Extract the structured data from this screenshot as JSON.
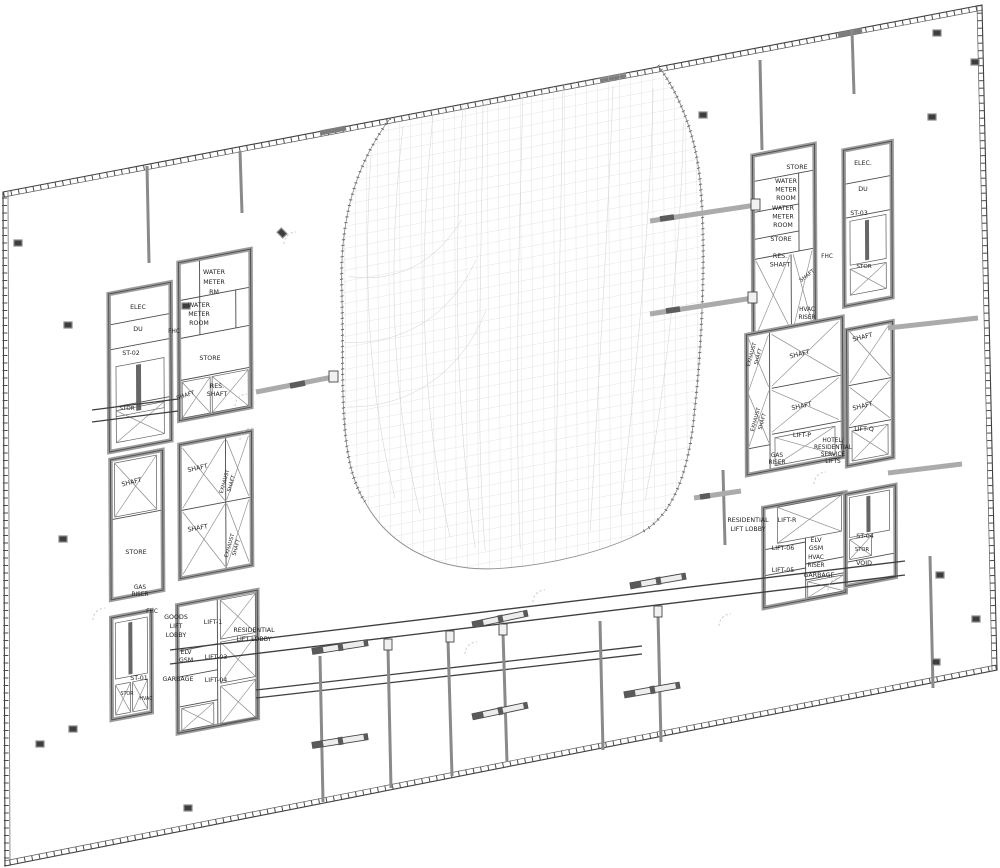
{
  "drawing": {
    "type": "architectural-floor-plan",
    "description": "High-rise tower typical floor plan, skewed axonometric view, central curved atrium void with gridshell mesh, two service cores with lifts, stairs and risers",
    "colors": {
      "background": "#ffffff",
      "line": "#3f3f3f",
      "wall_gray": "#9c9c9c",
      "mesh_gray": "#cbcbcb"
    }
  },
  "labels": [
    {
      "text": "ELEC",
      "x": 138,
      "y": 309
    },
    {
      "text": "DU",
      "x": 138,
      "y": 331
    },
    {
      "text": "ST-02",
      "x": 131,
      "y": 355
    },
    {
      "text": "STOR",
      "x": 127,
      "y": 410,
      "size": 5.6
    },
    {
      "text": "WATER\nMETER\nRM",
      "x": 214,
      "y": 274,
      "lead": 10
    },
    {
      "text": "WATER\nMETER\nROOM",
      "x": 199,
      "y": 307,
      "lead": 9
    },
    {
      "text": "FHC",
      "x": 174,
      "y": 333,
      "size": 5.8
    },
    {
      "text": "STORE",
      "x": 210,
      "y": 360
    },
    {
      "text": "SHAFT",
      "x": 186,
      "y": 397,
      "rot": -18,
      "size": 5.8
    },
    {
      "text": "RES.\nSHAFT",
      "x": 217,
      "y": 388,
      "lead": 8
    },
    {
      "text": "SHAFT",
      "x": 132,
      "y": 484,
      "rot": -14
    },
    {
      "text": "STORE",
      "x": 136,
      "y": 554
    },
    {
      "text": "GAS\nRISER",
      "x": 140,
      "y": 589,
      "lead": 7,
      "size": 5.8
    },
    {
      "text": "EXHAUST\nSHAFT",
      "x": 226,
      "y": 482,
      "rot": -74,
      "size": 5.2,
      "lead": 7
    },
    {
      "text": "SHAFT",
      "x": 198,
      "y": 470,
      "rot": -12
    },
    {
      "text": "SHAFT",
      "x": 198,
      "y": 530,
      "rot": -10
    },
    {
      "text": "EXHAUST\nSHAFT",
      "x": 231,
      "y": 546,
      "rot": -74,
      "size": 5.2,
      "lead": 7
    },
    {
      "text": "FHC",
      "x": 152,
      "y": 613,
      "size": 5.8
    },
    {
      "text": "GOODS\nLIFT\nLOBBY",
      "x": 176,
      "y": 619,
      "lead": 9
    },
    {
      "text": "LIFT-1",
      "x": 213,
      "y": 624
    },
    {
      "text": "RESIDENTIAL\nLIFT LOBBY",
      "x": 254,
      "y": 632,
      "lead": 9
    },
    {
      "text": "ELV\nGSM",
      "x": 186,
      "y": 654,
      "lead": 8
    },
    {
      "text": "LIFT-03",
      "x": 216,
      "y": 659
    },
    {
      "text": "GARBAGE",
      "x": 178,
      "y": 681
    },
    {
      "text": "LIFT-04",
      "x": 216,
      "y": 682
    },
    {
      "text": "ST-01",
      "x": 139,
      "y": 680
    },
    {
      "text": "STOR",
      "x": 127,
      "y": 695,
      "size": 4.8
    },
    {
      "text": "HVAC",
      "x": 146,
      "y": 700,
      "size": 4.8
    },
    {
      "text": "STORE",
      "x": 797,
      "y": 169
    },
    {
      "text": "WATER\nMETER\nROOM",
      "x": 786,
      "y": 183,
      "lead": 8.5
    },
    {
      "text": "WATER\nMETER\nROOM",
      "x": 783,
      "y": 210,
      "lead": 8.5
    },
    {
      "text": "STORE",
      "x": 781,
      "y": 241
    },
    {
      "text": "RES.\nSHAFT",
      "x": 780,
      "y": 258,
      "lead": 8.5
    },
    {
      "text": "SHAFT",
      "x": 808,
      "y": 277,
      "rot": -38,
      "size": 5.4
    },
    {
      "text": "FHC",
      "x": 827,
      "y": 258,
      "size": 5.8
    },
    {
      "text": "ELEC.",
      "x": 863,
      "y": 165
    },
    {
      "text": "DU",
      "x": 863,
      "y": 191
    },
    {
      "text": "ST-03",
      "x": 859,
      "y": 215
    },
    {
      "text": "STOR",
      "x": 864,
      "y": 268,
      "size": 5.6
    },
    {
      "text": "HVAC\nRISER",
      "x": 807,
      "y": 311,
      "lead": 8,
      "size": 5.8
    },
    {
      "text": "EXHAUST\nSHAFT",
      "x": 753,
      "y": 355,
      "rot": -74,
      "size": 5.2,
      "lead": 7
    },
    {
      "text": "SHAFT",
      "x": 800,
      "y": 356,
      "rot": -14
    },
    {
      "text": "EXHAUST\nSHAFT",
      "x": 757,
      "y": 420,
      "rot": -74,
      "size": 5.2,
      "lead": 7
    },
    {
      "text": "SHAFT",
      "x": 802,
      "y": 408,
      "rot": -12
    },
    {
      "text": "LIFT-P",
      "x": 802,
      "y": 437
    },
    {
      "text": "GAS\nRISER",
      "x": 777,
      "y": 457,
      "lead": 7,
      "size": 5.8
    },
    {
      "text": "HOTEL/\nRESIDENTIAL\nSERVICE\nLIFTS",
      "x": 833,
      "y": 442,
      "lead": 7,
      "size": 5.8
    },
    {
      "text": "SHAFT",
      "x": 863,
      "y": 339,
      "rot": -14
    },
    {
      "text": "SHAFT",
      "x": 863,
      "y": 408,
      "rot": -14
    },
    {
      "text": "LIFT-Q",
      "x": 864,
      "y": 431
    },
    {
      "text": "RESIDENTIAL\nLIFT LOBBY",
      "x": 748,
      "y": 522,
      "lead": 9
    },
    {
      "text": "LIFT-R",
      "x": 787,
      "y": 522
    },
    {
      "text": "LIFT-06",
      "x": 783,
      "y": 550
    },
    {
      "text": "ELV\nGSM",
      "x": 816,
      "y": 542,
      "lead": 8
    },
    {
      "text": "HVAC\nRISER",
      "x": 816,
      "y": 559,
      "lead": 8,
      "size": 5.8
    },
    {
      "text": "LIFT-05",
      "x": 783,
      "y": 572
    },
    {
      "text": "GARBAGE",
      "x": 819,
      "y": 577
    },
    {
      "text": "ST-04",
      "x": 865,
      "y": 538
    },
    {
      "text": "STOR",
      "x": 862,
      "y": 551,
      "size": 5.2
    },
    {
      "text": "VOID",
      "x": 864,
      "y": 565
    }
  ]
}
